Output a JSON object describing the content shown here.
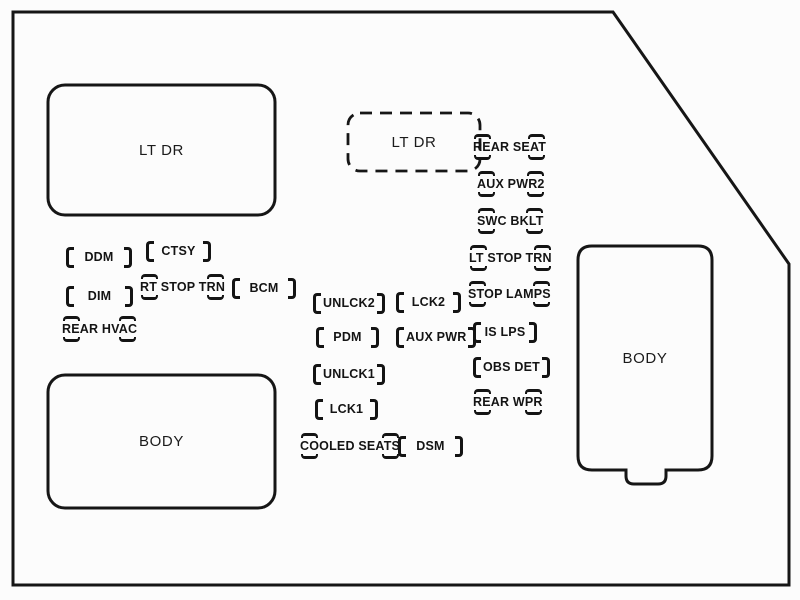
{
  "colors": {
    "line": "#161616",
    "background": "#fcfcfc"
  },
  "boxes": {
    "lt_dr_main": {
      "label": "LT DR"
    },
    "lt_dr_dashed": {
      "label": "LT DR"
    },
    "body_left": {
      "label": "BODY"
    },
    "body_right": {
      "label": "BODY"
    }
  },
  "fuses": [
    {
      "label": "DDM",
      "style": "bracket"
    },
    {
      "label": "CTSY",
      "style": "bracket"
    },
    {
      "label": "DIM",
      "style": "bracket"
    },
    {
      "label": "RT STOP TRN",
      "style": "marks"
    },
    {
      "label": "BCM",
      "style": "bracket"
    },
    {
      "label": "REAR HVAC",
      "style": "marks"
    },
    {
      "label": "UNLCK2",
      "style": "bracket"
    },
    {
      "label": "LCK2",
      "style": "bracket"
    },
    {
      "label": "PDM",
      "style": "bracket"
    },
    {
      "label": "AUX PWR",
      "style": "bracket"
    },
    {
      "label": "UNLCK1",
      "style": "bracket"
    },
    {
      "label": "LCK1",
      "style": "bracket"
    },
    {
      "label": "COOLED SEATS",
      "style": "marks"
    },
    {
      "label": "DSM",
      "style": "bracket"
    },
    {
      "label": "REAR SEAT",
      "style": "marks"
    },
    {
      "label": "AUX PWR2",
      "style": "marks"
    },
    {
      "label": "SWC BKLT",
      "style": "marks"
    },
    {
      "label": "LT STOP TRN",
      "style": "marks"
    },
    {
      "label": "STOP LAMPS",
      "style": "marks"
    },
    {
      "label": "IS LPS",
      "style": "bracket"
    },
    {
      "label": "OBS DET",
      "style": "bracket"
    },
    {
      "label": "REAR WPR",
      "style": "marks"
    }
  ]
}
